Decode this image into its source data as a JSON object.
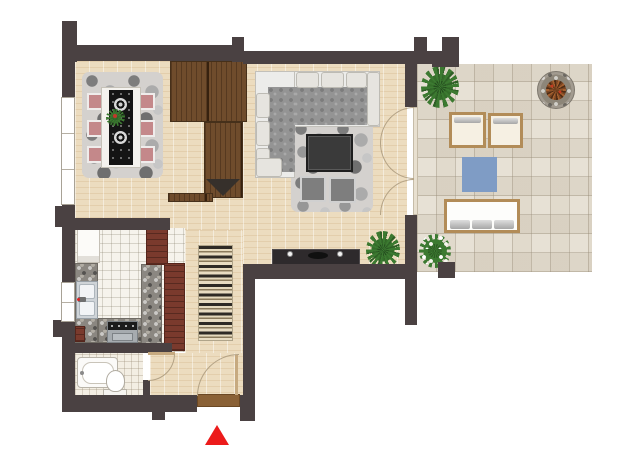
{
  "floor_plan": {
    "style": "top-down architectural rendering, no text labels",
    "entrance_marker": {
      "shape": "red-triangle-pointing-up",
      "color": "#ec1b1b"
    },
    "palette": {
      "walls": "#4a4142",
      "wood_floor": "#ecdcbf",
      "kitchen_tile": "#f6f3ec",
      "bathroom_tile": "#f3eee3",
      "terrace_pavers": "#e7e1d5",
      "wardrobe_wood": "#6f4c2c",
      "kitchen_cabinets_red": "#7a3a2d",
      "granite_counter": "#8b8781",
      "dining_chair_pink": "#c4888a",
      "pebble_rug_gray": "#d4d1ce",
      "runner_rug": "#2e2a25 / #e5d9bd / #8a7a5c",
      "outdoor_wood_frame": "#b28c58",
      "outdoor_blue_mat": "#7f9cc5",
      "plant_green": "#3c7a31",
      "sofa_cushion_gray": "#949494"
    },
    "rooms": [
      {
        "name": "dining-area",
        "items": [
          "dining-table",
          "black-ornament-table-runner",
          "two-medallions",
          "centerpiece-plant",
          "six-pink-chairs",
          "pebble-rug",
          "triple-pane-window"
        ]
      },
      {
        "name": "living-area",
        "items": [
          "l-shaped-corner-sofa",
          "back-pillows",
          "pebble-rug",
          "dark-coffee-table",
          "two-gray-poufs",
          "dark-sideboard",
          "two-lamps",
          "potted-plant",
          "triple-terrace-door-with-swing-arcs"
        ]
      },
      {
        "name": "kitchen",
        "items": [
          "fridge",
          "stainless-double-sink",
          "small-window",
          "cooktop-with-oven",
          "granite-counters",
          "red-tall-cabinets",
          "white-tile-floor"
        ]
      },
      {
        "name": "bathroom",
        "items": [
          "bathtub-with-faucet",
          "toilet",
          "swing-door"
        ]
      },
      {
        "name": "hallway",
        "items": [
          "l-shaped-wardrobe",
          "wavy-striped-runner-rug",
          "entry-door-with-swing-arc",
          "brown-threshold",
          "bathroom-door-arc"
        ]
      },
      {
        "name": "terrace",
        "items": [
          "two-wooden-lounge-chairs",
          "wooden-bench-with-cushions",
          "blue-square-mat",
          "round-fire-pit",
          "palm-plant",
          "flowering-plant",
          "stone-paver-floor",
          "corner-pillars"
        ]
      }
    ]
  }
}
